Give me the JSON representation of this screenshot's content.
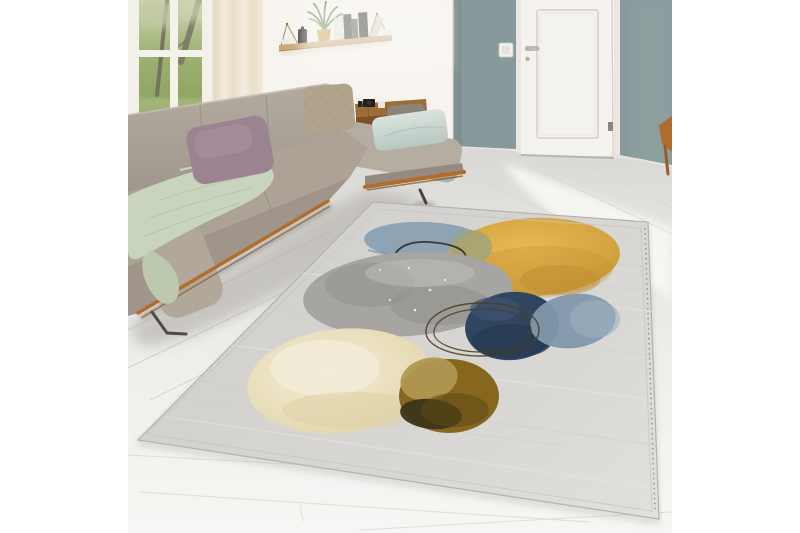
{
  "figure": {
    "type": "product-lifestyle-photo",
    "alt": "Bright living room with a beige boucle corner sofa beneath a garden window, a wall shelf with books and a potted plant, a white interior door set in a sage-teal wall, and a large abstract watercolor area rug with gray, yellow, blue, navy, cream and olive-brown circles lying on a whitewashed plank floor.",
    "canvas": {
      "width": 800,
      "height": 533,
      "background": "#ffffff"
    },
    "photo_area": {
      "left": 128,
      "top": 0,
      "width": 544,
      "height": 533
    }
  },
  "palette": {
    "canvas": "#ffffff",
    "wall_white": "#f7f4ef",
    "wall_teal": "#87999a",
    "wall_teal_dark": "#7b8d8e",
    "door": "#f4f2ee",
    "door_frame": "#e9e6e1",
    "baseboard": "#e8e5e0",
    "floor_light": "#f7f6f4",
    "floor_dark": "#dad8d4",
    "window_frame": "#f3f0ea",
    "garden_green": "#8ba268",
    "curtain": "#efe7d7",
    "shelf_wood": "#c9a877",
    "plant_green": "#5e7d49",
    "plant_pot": "#c7a140",
    "book_dark": "#302e2b",
    "book_light": "#e8e5de",
    "sofa_back": "#aba196",
    "sofa_seat": "#aca295",
    "sofa_front": "#9f958a",
    "sofa_corner": "#b1a79b",
    "sofa_chaise": "#b5ada1",
    "sofa_chaise_front": "#948a7f",
    "sofa_rail": "#b26c2b",
    "sofa_leg": "#514b44",
    "console_wood": "#9c6c39",
    "console_front": "#7d5226",
    "bolster_gray": "#8b8478",
    "blanket_sage": "#c9d4bd",
    "blanket_fold": "#bcc9ae",
    "pillow_mauve": "#9b8490",
    "pillow_mauve_light": "#ab95a0",
    "pillow_taupe": "#b2a48d",
    "pillow_mint": "#cfdcd6",
    "cup_white": "#eae7e1",
    "camera_black": "#23211f",
    "chair_wood": "#b06c2c",
    "rug_base_light": "#e0dfdc",
    "rug_base_dark": "#d2d1ce",
    "rug_yellow": "#d5a540",
    "rug_gray": "#a7a5a1",
    "rug_blue": "#8aa0b2",
    "rug_green_blend": "#99a37f",
    "rug_navy": "#30455f",
    "rug_steel": "#8299ac",
    "rug_cream": "#e8dcb8",
    "rug_olive": "#87671d",
    "rug_olive_dark": "#3c3418",
    "rug_khaki": "#b09752",
    "rug_ring_dark": "#2e2c28",
    "rug_ring_brown": "#4c3d22",
    "rug_stitch": "#8e8c88"
  },
  "objects": {
    "window": {
      "label": "Window with garden view"
    },
    "curtain": {
      "label": "Sheer cream curtain"
    },
    "shelf": {
      "label": "Hanging wall shelf with books, canister and potted plant"
    },
    "teal_wall": {
      "label": "Sage-teal accent wall"
    },
    "door": {
      "label": "White interior door with handle and hinge"
    },
    "switch": {
      "label": "Light switch"
    },
    "chair": {
      "label": "Wooden chair at photo edge"
    },
    "floor": {
      "label": "Whitewashed wood plank floor"
    },
    "sofa": {
      "label": "Beige boucle corner sofa with wooden rail"
    },
    "blanket": {
      "label": "Sage green knit throw blanket"
    },
    "pillow_mauve": {
      "label": "Dusty mauve cushion"
    },
    "pillow_taupe": {
      "label": "Quilted taupe cushion"
    },
    "pillow_mint": {
      "label": "Pale mint cushion"
    },
    "console": {
      "label": "Wooden side console with small black and white cups"
    },
    "rug": {
      "label": "Abstract watercolor area rug with circles in yellow, gray, blue, navy, cream and olive"
    },
    "rug_motifs": {
      "label": "Watercolor circles: mustard-yellow disc, mottled gray blob, steel-blue wash, dark navy blob, cream disc, olive-brown disc, thin outline rings"
    }
  }
}
